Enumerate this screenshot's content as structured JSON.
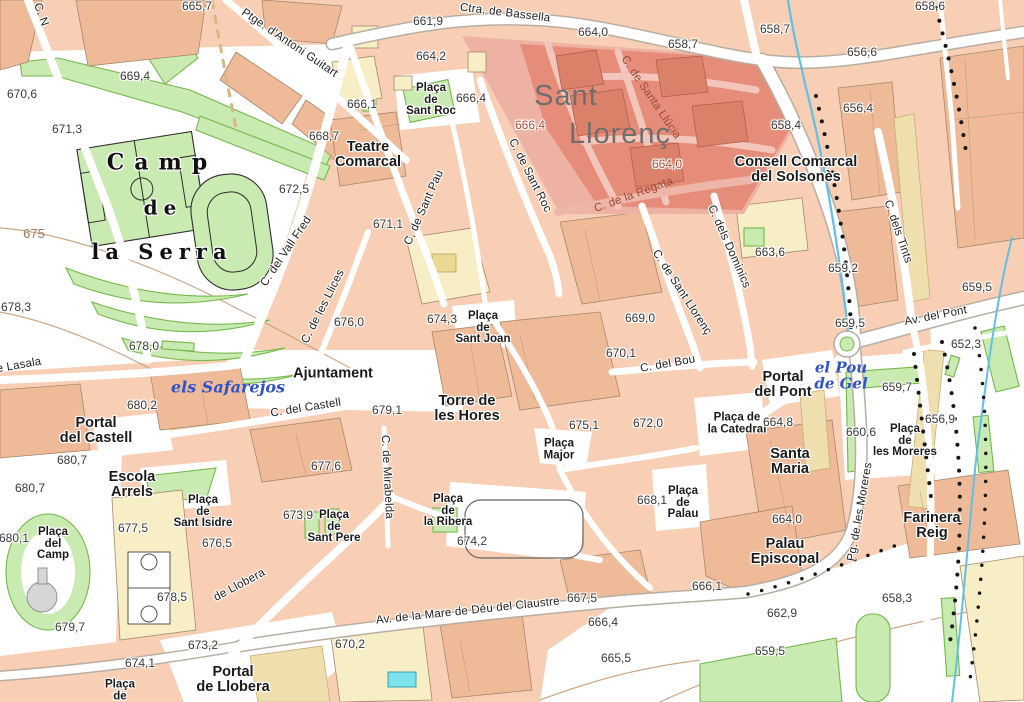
{
  "colors": {
    "background": "#f8cfb5",
    "building": "#efba98",
    "building_outline": "#a5886c",
    "cream": "#f7eec6",
    "tan": "#efdfae",
    "green": "#c9eab0",
    "green_dark": "#74b84c",
    "road": "#ffffff",
    "road_casing": "#b7aea1",
    "highlight": "#e58d79",
    "highlight_light": "#eeb2a4",
    "highlight_street": "#f4c6bb",
    "building_red": "#db8069",
    "water": "#5fc0e8",
    "contour": "#c49a76",
    "label": "#1b1b1b",
    "street_red": "#9a4a3a",
    "elev_red": "#b2503f",
    "water_label": "#2f52c8",
    "title": "#6e6e6e",
    "contour_label": "#a87a56",
    "pool": "#7de2ec"
  },
  "district": {
    "highlight_name": "Sant Llorenç"
  },
  "labels": [
    {
      "t": "Sant",
      "x": 566,
      "y": 96,
      "c": "title"
    },
    {
      "t": "Llorenç",
      "x": 620,
      "y": 134,
      "c": "title"
    },
    {
      "t": "Camp",
      "x": 162,
      "y": 163,
      "c": "serif",
      "s": 22,
      "ls": 10
    },
    {
      "t": "de",
      "x": 163,
      "y": 208,
      "c": "serif",
      "s": 20,
      "ls": 6
    },
    {
      "t": "la Serra",
      "x": 162,
      "y": 252,
      "c": "serif",
      "s": 21,
      "ls": 6
    },
    {
      "t": "Plaça\nde\nSant Roc",
      "x": 431,
      "y": 100,
      "c": "plaza"
    },
    {
      "t": "Teatre\nComarcal",
      "x": 368,
      "y": 155,
      "c": "place"
    },
    {
      "t": "Consell Comarcal\ndel Solsonès",
      "x": 796,
      "y": 170,
      "c": "place"
    },
    {
      "t": "Ajuntament",
      "x": 333,
      "y": 374,
      "c": "place"
    },
    {
      "t": "Torre de\nles Hores",
      "x": 467,
      "y": 409,
      "c": "place"
    },
    {
      "t": "Portal\ndel Castell",
      "x": 96,
      "y": 431,
      "c": "place"
    },
    {
      "t": "Escola\nArrels",
      "x": 132,
      "y": 485,
      "c": "place"
    },
    {
      "t": "Plaça\nde\nSant Isidre",
      "x": 203,
      "y": 512,
      "c": "plaza"
    },
    {
      "t": "Plaça\ndel\nCamp",
      "x": 53,
      "y": 544,
      "c": "plaza"
    },
    {
      "t": "Plaça\nde\nSant Pere",
      "x": 334,
      "y": 527,
      "c": "plaza"
    },
    {
      "t": "Plaça\nde\nla Ribera",
      "x": 448,
      "y": 511,
      "c": "plaza"
    },
    {
      "t": "Plaça\nMajor",
      "x": 559,
      "y": 450,
      "c": "plaza"
    },
    {
      "t": "Plaça\nde\nSant Joan",
      "x": 483,
      "y": 328,
      "c": "plaza"
    },
    {
      "t": "Plaça de\nla Catedral",
      "x": 737,
      "y": 424,
      "c": "plaza"
    },
    {
      "t": "Santa\nMaria",
      "x": 790,
      "y": 462,
      "c": "place"
    },
    {
      "t": "Plaça\nde\nPalau",
      "x": 683,
      "y": 503,
      "c": "plaza"
    },
    {
      "t": "Plaça\nde\nles Moreres",
      "x": 905,
      "y": 441,
      "c": "plaza"
    },
    {
      "t": "Portal\ndel Pont",
      "x": 783,
      "y": 385,
      "c": "place"
    },
    {
      "t": "Palau\nEpiscopal",
      "x": 785,
      "y": 552,
      "c": "place"
    },
    {
      "t": "Farinera\nReig",
      "x": 932,
      "y": 526,
      "c": "place"
    },
    {
      "t": "Portal\nde Llobera",
      "x": 233,
      "y": 680,
      "c": "place"
    },
    {
      "t": "Plaça\nde",
      "x": 120,
      "y": 691,
      "c": "plaza"
    },
    {
      "t": "Ctra. de Bassella",
      "x": 505,
      "y": 14,
      "r": 7,
      "c": "street"
    },
    {
      "t": "Ptge. d'Antoni Guitart",
      "x": 289,
      "y": 44,
      "r": 34,
      "c": "street"
    },
    {
      "t": "C. N",
      "x": 40,
      "y": 15,
      "r": 70,
      "c": "street"
    },
    {
      "t": "C. del Vall Fred",
      "x": 287,
      "y": 252,
      "r": -56,
      "c": "street"
    },
    {
      "t": "C. de les Llices",
      "x": 324,
      "y": 307,
      "r": -63,
      "c": "street"
    },
    {
      "t": "C. de Sant Pau",
      "x": 425,
      "y": 208,
      "r": -66,
      "c": "street"
    },
    {
      "t": "C. de Sant Roc",
      "x": 529,
      "y": 176,
      "r": 63,
      "c": "street"
    },
    {
      "t": "C. de Santa Llúcia",
      "x": 650,
      "y": 98,
      "r": 56,
      "c": "streetred"
    },
    {
      "t": "C. de la Regata",
      "x": 634,
      "y": 196,
      "r": -20,
      "c": "streetred"
    },
    {
      "t": "C. dels Dominics",
      "x": 728,
      "y": 247,
      "r": 66,
      "c": "street"
    },
    {
      "t": "C. de Sant Llorenç",
      "x": 681,
      "y": 293,
      "r": 57,
      "c": "street"
    },
    {
      "t": "C. del Bou",
      "x": 668,
      "y": 365,
      "r": -10,
      "c": "street"
    },
    {
      "t": "C. dels Tints",
      "x": 897,
      "y": 232,
      "r": 71,
      "c": "street"
    },
    {
      "t": "Av. del Pont",
      "x": 936,
      "y": 317,
      "r": -11,
      "c": "street"
    },
    {
      "t": "C. del Castell",
      "x": 306,
      "y": 409,
      "r": -9,
      "c": "street"
    },
    {
      "t": "C. de Mirabelda",
      "x": 386,
      "y": 477,
      "r": 87,
      "c": "street"
    },
    {
      "t": "de Llobera",
      "x": 240,
      "y": 586,
      "r": -28,
      "c": "street"
    },
    {
      "t": "Av. de la Mare de Déu del Claustre",
      "x": 468,
      "y": 612,
      "r": -6,
      "c": "street"
    },
    {
      "t": "Pg. de les Moreres",
      "x": 861,
      "y": 512,
      "r": -80,
      "c": "street"
    },
    {
      "t": "de Lasala",
      "x": 16,
      "y": 367,
      "r": -10,
      "c": "street"
    },
    {
      "t": "els Safarejos",
      "x": 228,
      "y": 388,
      "c": "water"
    },
    {
      "t": "el Pou\nde Gel",
      "x": 841,
      "y": 376,
      "c": "water",
      "s": 15
    },
    {
      "t": "675",
      "x": 34,
      "y": 234,
      "c": "contour"
    },
    {
      "t": "665,7",
      "x": 197,
      "y": 6,
      "c": "elev"
    },
    {
      "t": "661,9",
      "x": 428,
      "y": 21,
      "c": "elev"
    },
    {
      "t": "664,0",
      "x": 593,
      "y": 32,
      "c": "elev"
    },
    {
      "t": "658,7",
      "x": 683,
      "y": 44,
      "c": "elev"
    },
    {
      "t": "658,7",
      "x": 775,
      "y": 29,
      "c": "elev"
    },
    {
      "t": "658,6",
      "x": 930,
      "y": 6,
      "c": "elev"
    },
    {
      "t": "664,2",
      "x": 431,
      "y": 56,
      "c": "elev"
    },
    {
      "t": "669,4",
      "x": 135,
      "y": 76,
      "c": "elev"
    },
    {
      "t": "670,6",
      "x": 22,
      "y": 94,
      "c": "elev"
    },
    {
      "t": "671,3",
      "x": 67,
      "y": 129,
      "c": "elev"
    },
    {
      "t": "668,7",
      "x": 324,
      "y": 136,
      "c": "elev"
    },
    {
      "t": "666,1",
      "x": 362,
      "y": 104,
      "c": "elev"
    },
    {
      "t": "666,4",
      "x": 471,
      "y": 98,
      "c": "elev"
    },
    {
      "t": "666,4",
      "x": 530,
      "y": 125,
      "c": "elevred"
    },
    {
      "t": "656,6",
      "x": 862,
      "y": 52,
      "c": "elev"
    },
    {
      "t": "656,4",
      "x": 858,
      "y": 108,
      "c": "elev"
    },
    {
      "t": "658,4",
      "x": 786,
      "y": 125,
      "c": "elev"
    },
    {
      "t": "664,0",
      "x": 667,
      "y": 164,
      "c": "elevred"
    },
    {
      "t": "672,5",
      "x": 294,
      "y": 189,
      "c": "elev"
    },
    {
      "t": "671,1",
      "x": 388,
      "y": 224,
      "c": "elev"
    },
    {
      "t": "663,6",
      "x": 770,
      "y": 252,
      "c": "elev"
    },
    {
      "t": "659,2",
      "x": 843,
      "y": 268,
      "c": "elev"
    },
    {
      "t": "659,5",
      "x": 977,
      "y": 287,
      "c": "elev"
    },
    {
      "t": "678,3",
      "x": 16,
      "y": 307,
      "c": "elev"
    },
    {
      "t": "674,3",
      "x": 442,
      "y": 319,
      "c": "elev"
    },
    {
      "t": "669,0",
      "x": 640,
      "y": 318,
      "c": "elev"
    },
    {
      "t": "676,0",
      "x": 349,
      "y": 322,
      "c": "elev"
    },
    {
      "t": "670,1",
      "x": 621,
      "y": 353,
      "c": "elev"
    },
    {
      "t": "659,5",
      "x": 850,
      "y": 323,
      "c": "elev"
    },
    {
      "t": "678,0",
      "x": 144,
      "y": 346,
      "c": "elev"
    },
    {
      "t": "680,2",
      "x": 142,
      "y": 405,
      "c": "elev"
    },
    {
      "t": "679,1",
      "x": 387,
      "y": 410,
      "c": "elev"
    },
    {
      "t": "675,1",
      "x": 584,
      "y": 425,
      "c": "elev"
    },
    {
      "t": "672,0",
      "x": 648,
      "y": 423,
      "c": "elev"
    },
    {
      "t": "664,8",
      "x": 778,
      "y": 422,
      "c": "elev"
    },
    {
      "t": "660,6",
      "x": 861,
      "y": 432,
      "c": "elev"
    },
    {
      "t": "656,9",
      "x": 940,
      "y": 419,
      "c": "elev"
    },
    {
      "t": "659,7",
      "x": 897,
      "y": 387,
      "c": "elev"
    },
    {
      "t": "652,3",
      "x": 966,
      "y": 344,
      "c": "elev"
    },
    {
      "t": "677,6",
      "x": 326,
      "y": 466,
      "c": "elev"
    },
    {
      "t": "680,7",
      "x": 72,
      "y": 460,
      "c": "elev"
    },
    {
      "t": "680,7",
      "x": 30,
      "y": 488,
      "c": "elev"
    },
    {
      "t": "668,1",
      "x": 652,
      "y": 500,
      "c": "elev"
    },
    {
      "t": "673,9",
      "x": 298,
      "y": 515,
      "c": "elev"
    },
    {
      "t": "677,5",
      "x": 133,
      "y": 528,
      "c": "elev"
    },
    {
      "t": "676,5",
      "x": 217,
      "y": 543,
      "c": "elev"
    },
    {
      "t": "680,1",
      "x": 14,
      "y": 538,
      "c": "elev"
    },
    {
      "t": "678,5",
      "x": 172,
      "y": 597,
      "c": "elev"
    },
    {
      "t": "679,7",
      "x": 70,
      "y": 627,
      "c": "elev"
    },
    {
      "t": "673,2",
      "x": 203,
      "y": 645,
      "c": "elev"
    },
    {
      "t": "674,1",
      "x": 140,
      "y": 663,
      "c": "elev"
    },
    {
      "t": "674,2",
      "x": 472,
      "y": 541,
      "c": "elev"
    },
    {
      "t": "667,5",
      "x": 582,
      "y": 598,
      "c": "elev"
    },
    {
      "t": "666,4",
      "x": 603,
      "y": 622,
      "c": "elev"
    },
    {
      "t": "670,2",
      "x": 350,
      "y": 644,
      "c": "elev"
    },
    {
      "t": "665,5",
      "x": 616,
      "y": 658,
      "c": "elev"
    },
    {
      "t": "664,0",
      "x": 787,
      "y": 519,
      "c": "elev"
    },
    {
      "t": "666,1",
      "x": 707,
      "y": 586,
      "c": "elev"
    },
    {
      "t": "662,9",
      "x": 782,
      "y": 613,
      "c": "elev"
    },
    {
      "t": "658,3",
      "x": 897,
      "y": 598,
      "c": "elev"
    },
    {
      "t": "659,5",
      "x": 770,
      "y": 651,
      "c": "elev"
    }
  ]
}
